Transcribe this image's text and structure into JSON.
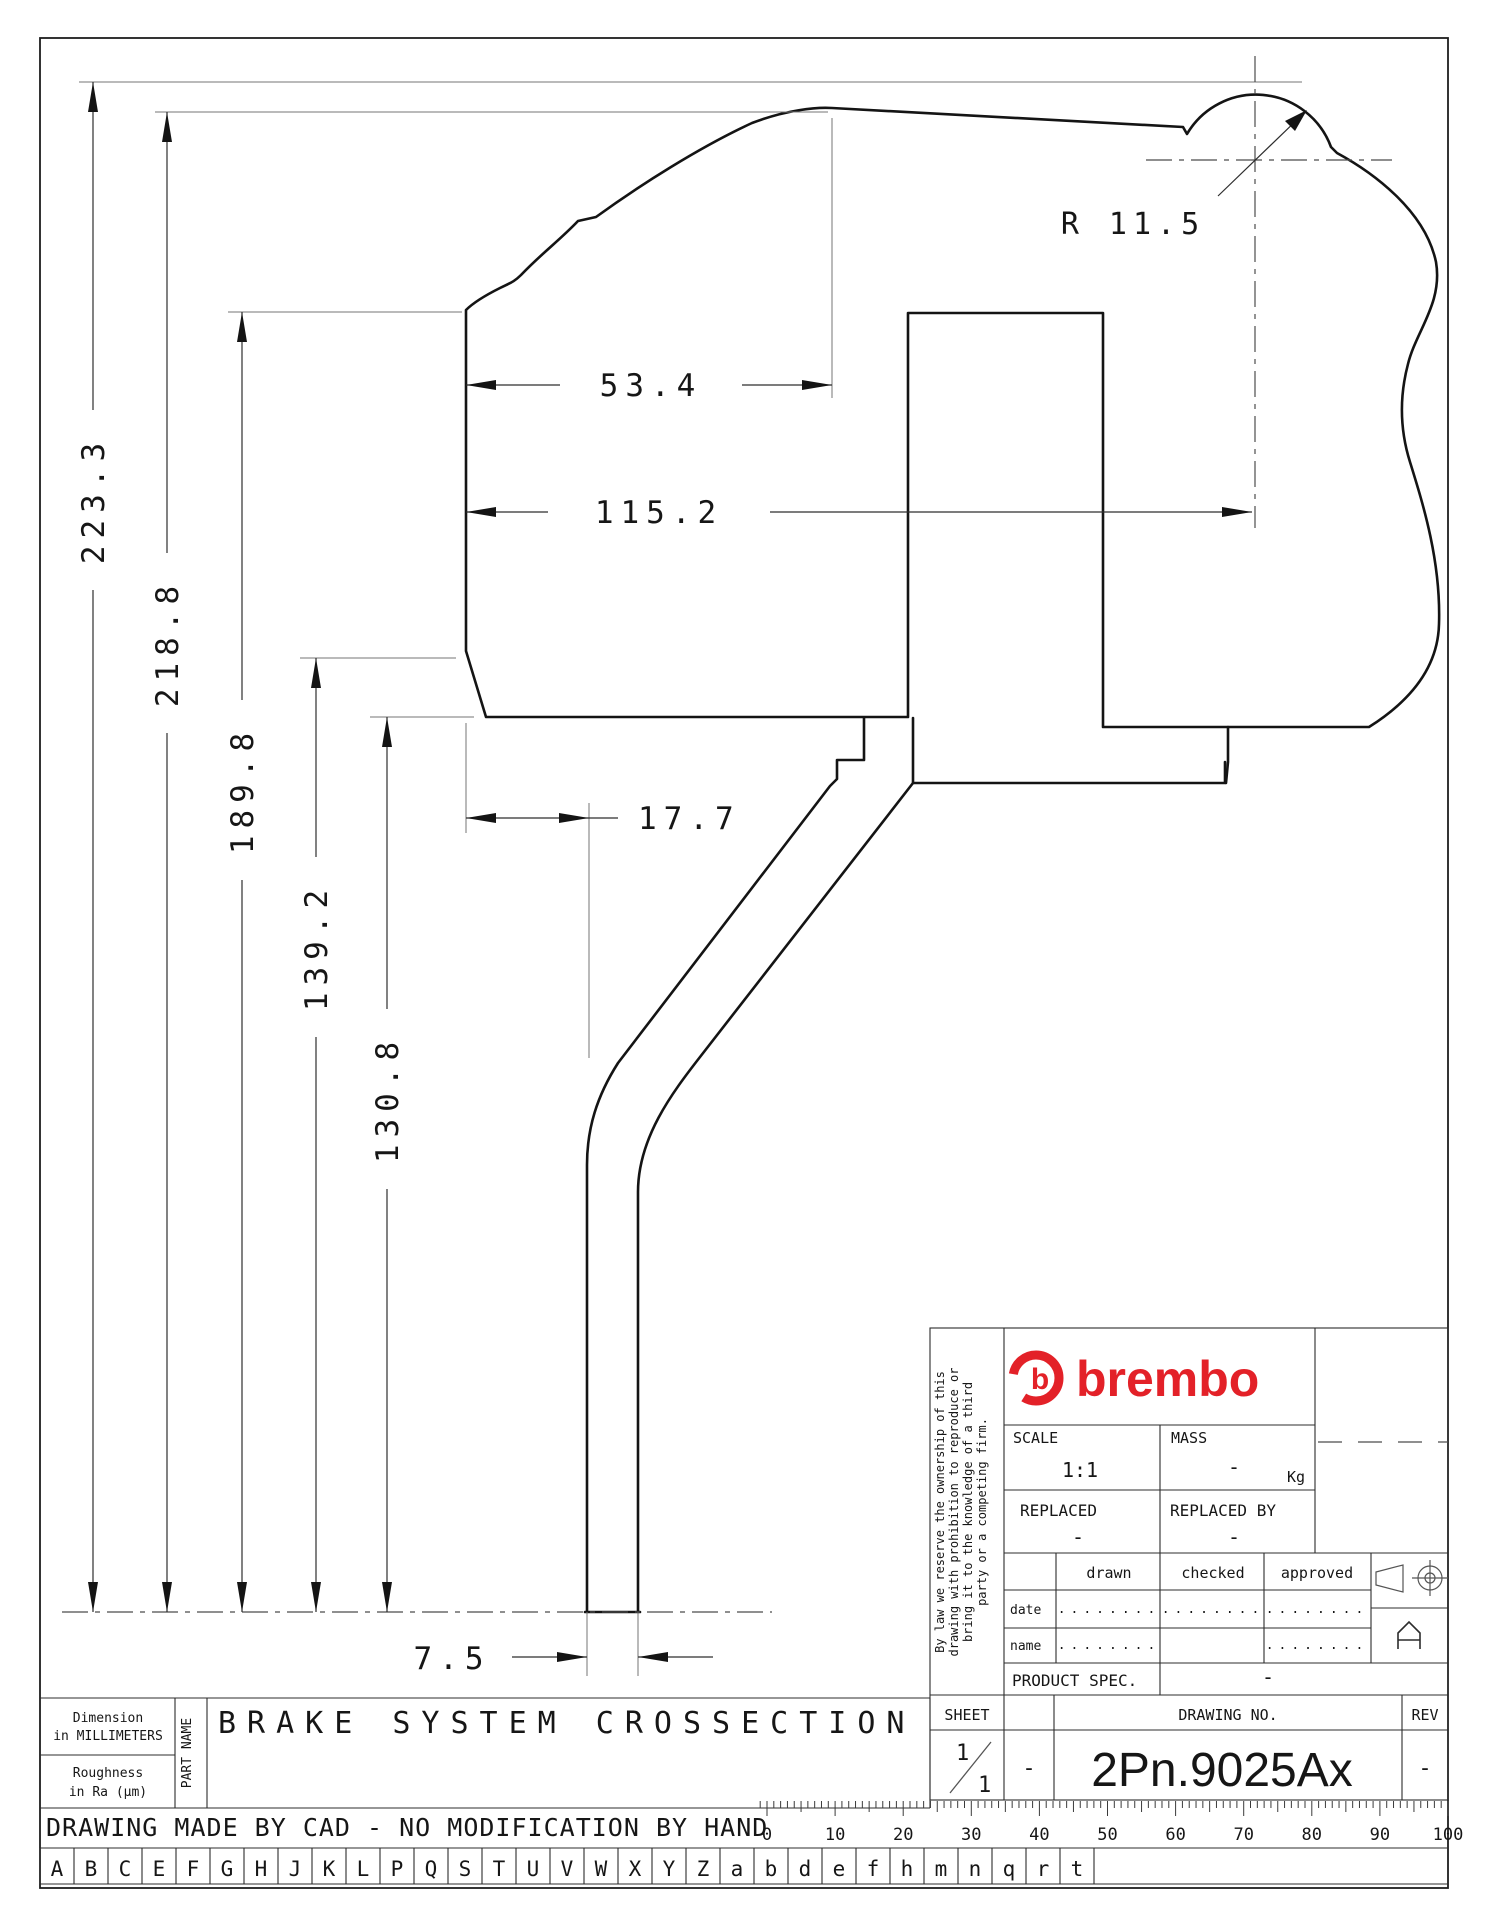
{
  "colors": {
    "brand_red": "#e32128",
    "line_black": "#141414",
    "thin_gray": "#767676"
  },
  "drawing": {
    "dimensions": {
      "vertical": [
        "223.3",
        "218.8",
        "189.8",
        "139.2",
        "130.8"
      ],
      "horizontal": [
        "53.4",
        "115.2",
        "17.7",
        "7.5"
      ],
      "radius": "R 11.5"
    }
  },
  "sheet": {
    "part_title": "BRAKE SYSTEM CROSSECTION",
    "note": "DRAWING MADE BY CAD - NO MODIFICATION BY HAND",
    "left_info": {
      "dimension_line1": "Dimension",
      "dimension_line2": "in MILLIMETERS",
      "roughness_line1": "Roughness",
      "roughness_line2": "in Ra (μm)",
      "part_name_label": "PART NAME"
    },
    "revision_letters": [
      "A",
      "B",
      "C",
      "E",
      "F",
      "G",
      "H",
      "J",
      "K",
      "L",
      "P",
      "Q",
      "S",
      "T",
      "U",
      "V",
      "W",
      "X",
      "Y",
      "Z",
      "a",
      "b",
      "d",
      "e",
      "f",
      "h",
      "m",
      "n",
      "q",
      "r",
      "t"
    ],
    "ruler_numbers": [
      "0",
      "10",
      "20",
      "30",
      "40",
      "50",
      "60",
      "70",
      "80",
      "90",
      "100"
    ]
  },
  "title_block": {
    "brand": "brembo",
    "brand_icon": "b",
    "disclaimer_lines": [
      "By law we reserve the ownership of this",
      "drawing with prohibition to reproduce or",
      "bring it to the knowledge of a third",
      "party or a competing firm."
    ],
    "scale": {
      "label": "SCALE",
      "value": "1:1"
    },
    "mass": {
      "label": "MASS",
      "value": "-",
      "unit": "Kg"
    },
    "replaced": {
      "label": "REPLACED",
      "value": "-"
    },
    "replaced_by": {
      "label": "REPLACED BY",
      "value": "-"
    },
    "sign_table": {
      "headers": [
        "drawn",
        "checked",
        "approved"
      ],
      "rows": [
        {
          "label": "date",
          "drawn": "........",
          "checked": "........",
          "approved": "........"
        },
        {
          "label": "name",
          "drawn": "........",
          "checked": "",
          "approved": "........"
        }
      ]
    },
    "product_spec": {
      "label": "PRODUCT SPEC.",
      "value": "-"
    },
    "sheet_cell": {
      "label": "SHEET",
      "numerator": "1",
      "denominator": "1",
      "dash": "-"
    },
    "drawing_no": {
      "label": "DRAWING NO.",
      "value": "2Pn.9025Ax"
    },
    "rev": {
      "label": "REV",
      "value": "-"
    },
    "size_letter": "A"
  }
}
